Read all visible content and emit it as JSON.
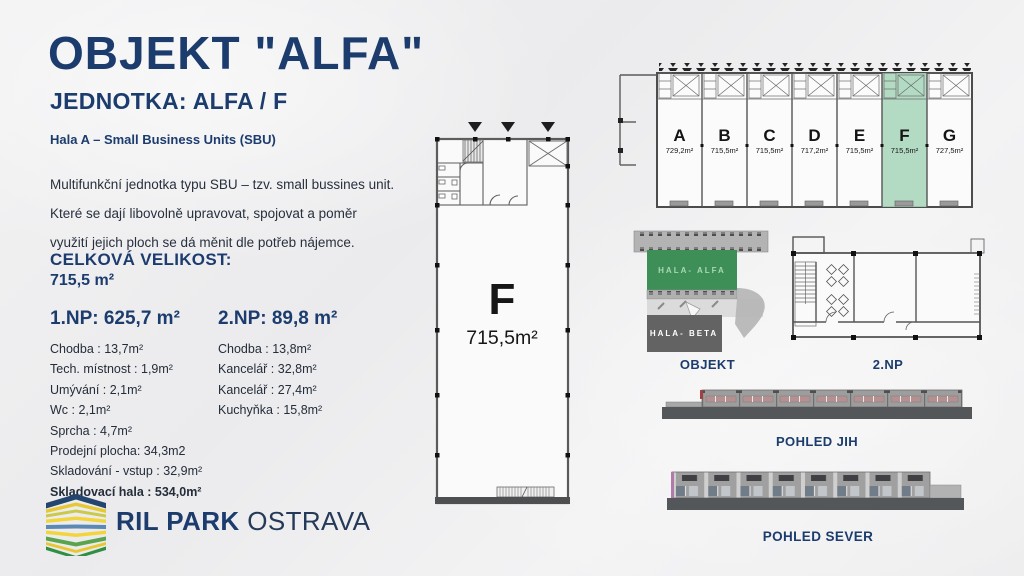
{
  "header": {
    "title": "OBJEKT \"ALFA\"",
    "subtitle": "JEDNOTKA: ALFA / F",
    "section_label": "Hala A – Small Business Units (SBU)",
    "description": "Multifunkční jednotka typu SBU – tzv. small bussines unit.  Které se dají libovolně upravovat, spojovat a poměr využití jejich ploch se dá měnit dle potřeb nájemce."
  },
  "totals": {
    "label": "CELKOVÁ VELIKOST:",
    "value": "715,5 m²"
  },
  "np1": {
    "title": "1.NP: 625,7 m²",
    "items": [
      "Chodba : 13,7m²",
      "Tech. místnost : 1,9m²",
      "Umývání : 2,1m²",
      "Wc : 2,1m²",
      "Sprcha : 4,7m²",
      "Prodejní plocha: 34,3m2",
      "Skladování - vstup : 32,9m²"
    ],
    "bold_item": "Skladovací hala : 534,0m²"
  },
  "np2": {
    "title": "2.NP: 89,8 m²",
    "items": [
      "Chodba : 13,8m²",
      "Kancelář : 32,8m²",
      "Kancelář : 27,4m²",
      "Kuchyňka : 15,8m²"
    ]
  },
  "unit_plan": {
    "letter": "F",
    "area": "715,5m²"
  },
  "hall_plan": {
    "units": [
      {
        "label": "A",
        "area": "729,2m²"
      },
      {
        "label": "B",
        "area": "715,5m²"
      },
      {
        "label": "C",
        "area": "715,5m²"
      },
      {
        "label": "D",
        "area": "717,2m²"
      },
      {
        "label": "E",
        "area": "715,5m²"
      },
      {
        "label": "F",
        "area": "715,5m²",
        "highlighted": true
      },
      {
        "label": "G",
        "area": "727,5m²"
      }
    ]
  },
  "site_plan": {
    "hala_alfa_label": "HALA- ALFA",
    "hala_beta_label": "HALA- BETA",
    "caption": "OBJEKT"
  },
  "np2_plan": {
    "caption": "2.NP"
  },
  "elevation_south": {
    "caption": "POHLED JIH"
  },
  "elevation_north": {
    "caption": "POHLED SEVER"
  },
  "logo": {
    "brand": "RIL PARK",
    "city": "OSTRAVA"
  },
  "colors": {
    "navy": "#1c3c6e",
    "highlight_green": "#a9d6bb",
    "hala_alfa_green": "#3d8f57",
    "hala_beta_gray": "#636363",
    "background": "#f0f0f1"
  }
}
